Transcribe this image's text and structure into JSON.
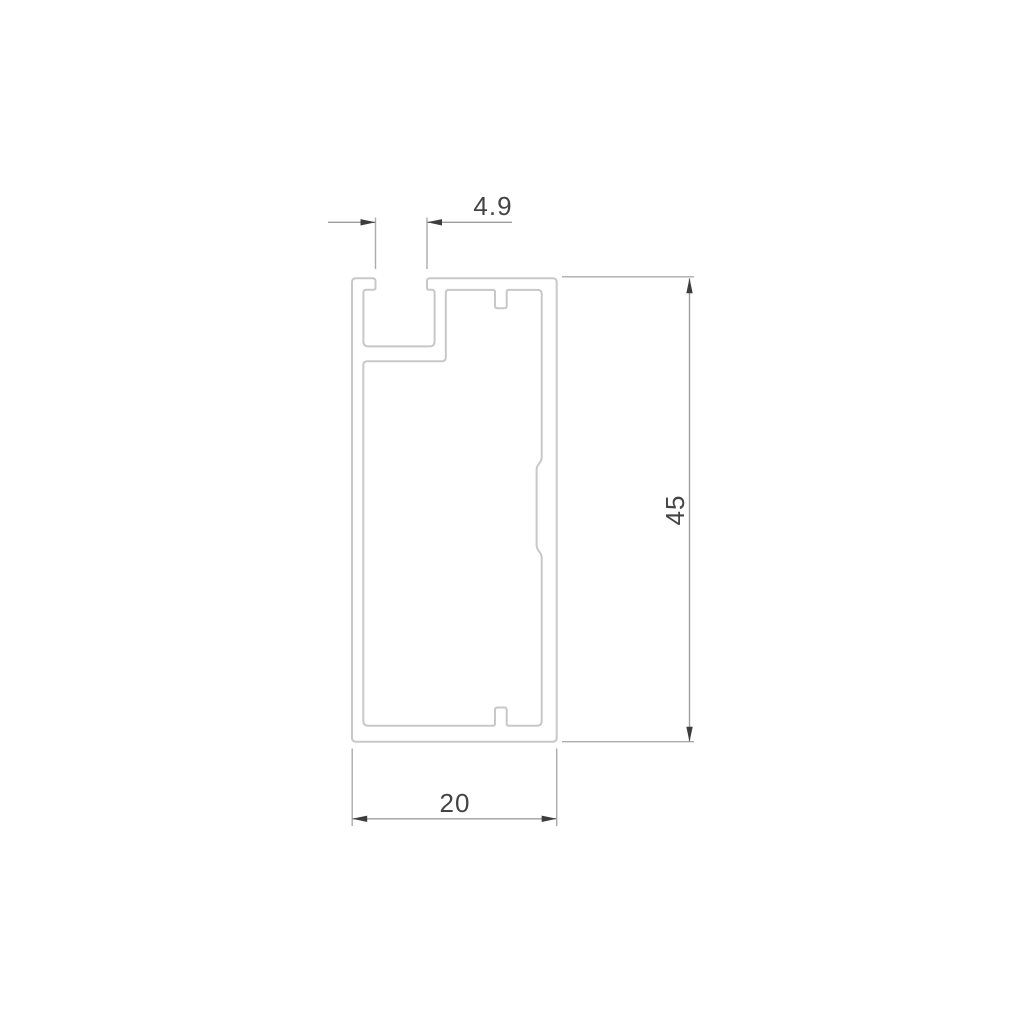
{
  "drawing": {
    "type": "technical-profile-cross-section",
    "background_color": "#ffffff",
    "profile_line_color": "#c8c8c8",
    "extension_line_color": "#ababab",
    "dimension_line_color": "#9e9e9e",
    "arrow_color": "#3d3d3d",
    "text_color": "#444444",
    "dimensions": {
      "slot_width": {
        "label": "4.9"
      },
      "height": {
        "label": "45"
      },
      "width": {
        "label": "20"
      }
    }
  }
}
